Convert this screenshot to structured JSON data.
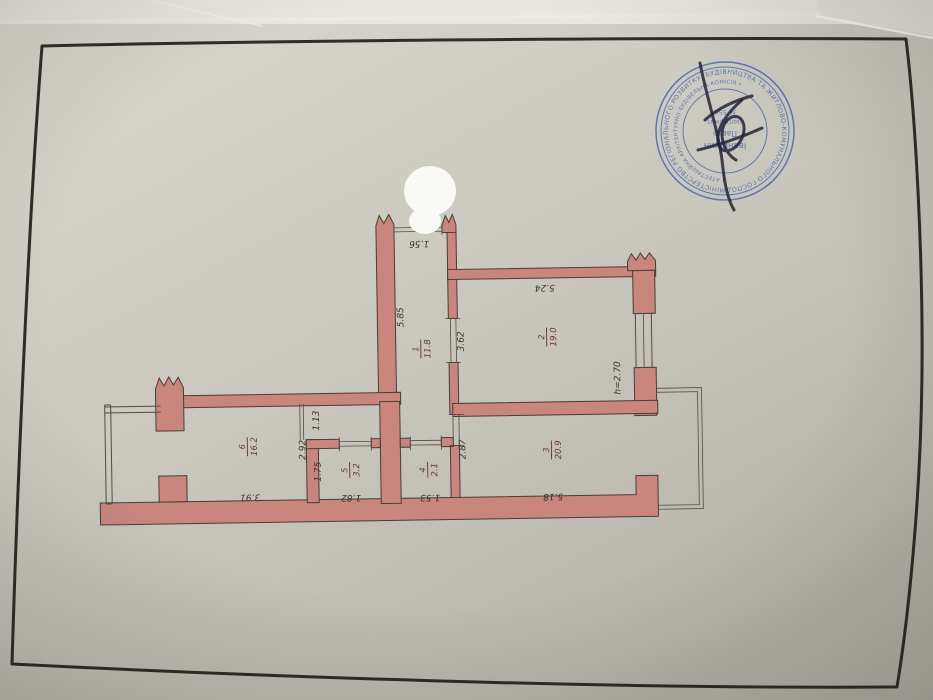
{
  "floor_plan": {
    "rooms": [
      {
        "number": "1",
        "area": "11.8"
      },
      {
        "number": "2",
        "area": "19.0"
      },
      {
        "number": "3",
        "area": "20.9"
      },
      {
        "number": "4",
        "area": "2.1"
      },
      {
        "number": "5",
        "area": "3.2"
      },
      {
        "number": "6",
        "area": "16.2"
      }
    ],
    "dimensions": {
      "entry_door": "1.56",
      "corridor_length": "5.85",
      "room2_depth": "3.62",
      "room2_width": "5.24",
      "ceiling_height": "h=2.70",
      "room3_depth": "2.87",
      "room3_width": "5.18",
      "room4_width": "1.53",
      "room5_width": "1.82",
      "room5_depth": "1.75",
      "hall_depth": "2.92",
      "passage_width": "1.13",
      "room6_width": "3.91"
    },
    "colors": {
      "wall": "#c8867f",
      "paper": "#cbc9bf",
      "room_label": "#6b332b",
      "dimension_label": "#36342e"
    }
  },
  "stamp": {
    "color": "#4565a8",
    "ring_text": "МІНІСТЕРСТВО РЕГІОНАЛЬНОГО РОЗВИТКУ, БУДІВНИЦТВА ТА ЖИТЛОВО-КОМУНАЛЬНОГО ГОСПОДАРСТВА • УКРАЇНА •",
    "inner_ring_text": "• АТЕСТАЦІЙНА АРХІТЕКТУРНО-БУДІВЕЛЬНА КОМІСІЯ •",
    "center_lines": [
      "Іванишин",
      "Павло",
      "сертифікат",
      "№ 556"
    ]
  }
}
